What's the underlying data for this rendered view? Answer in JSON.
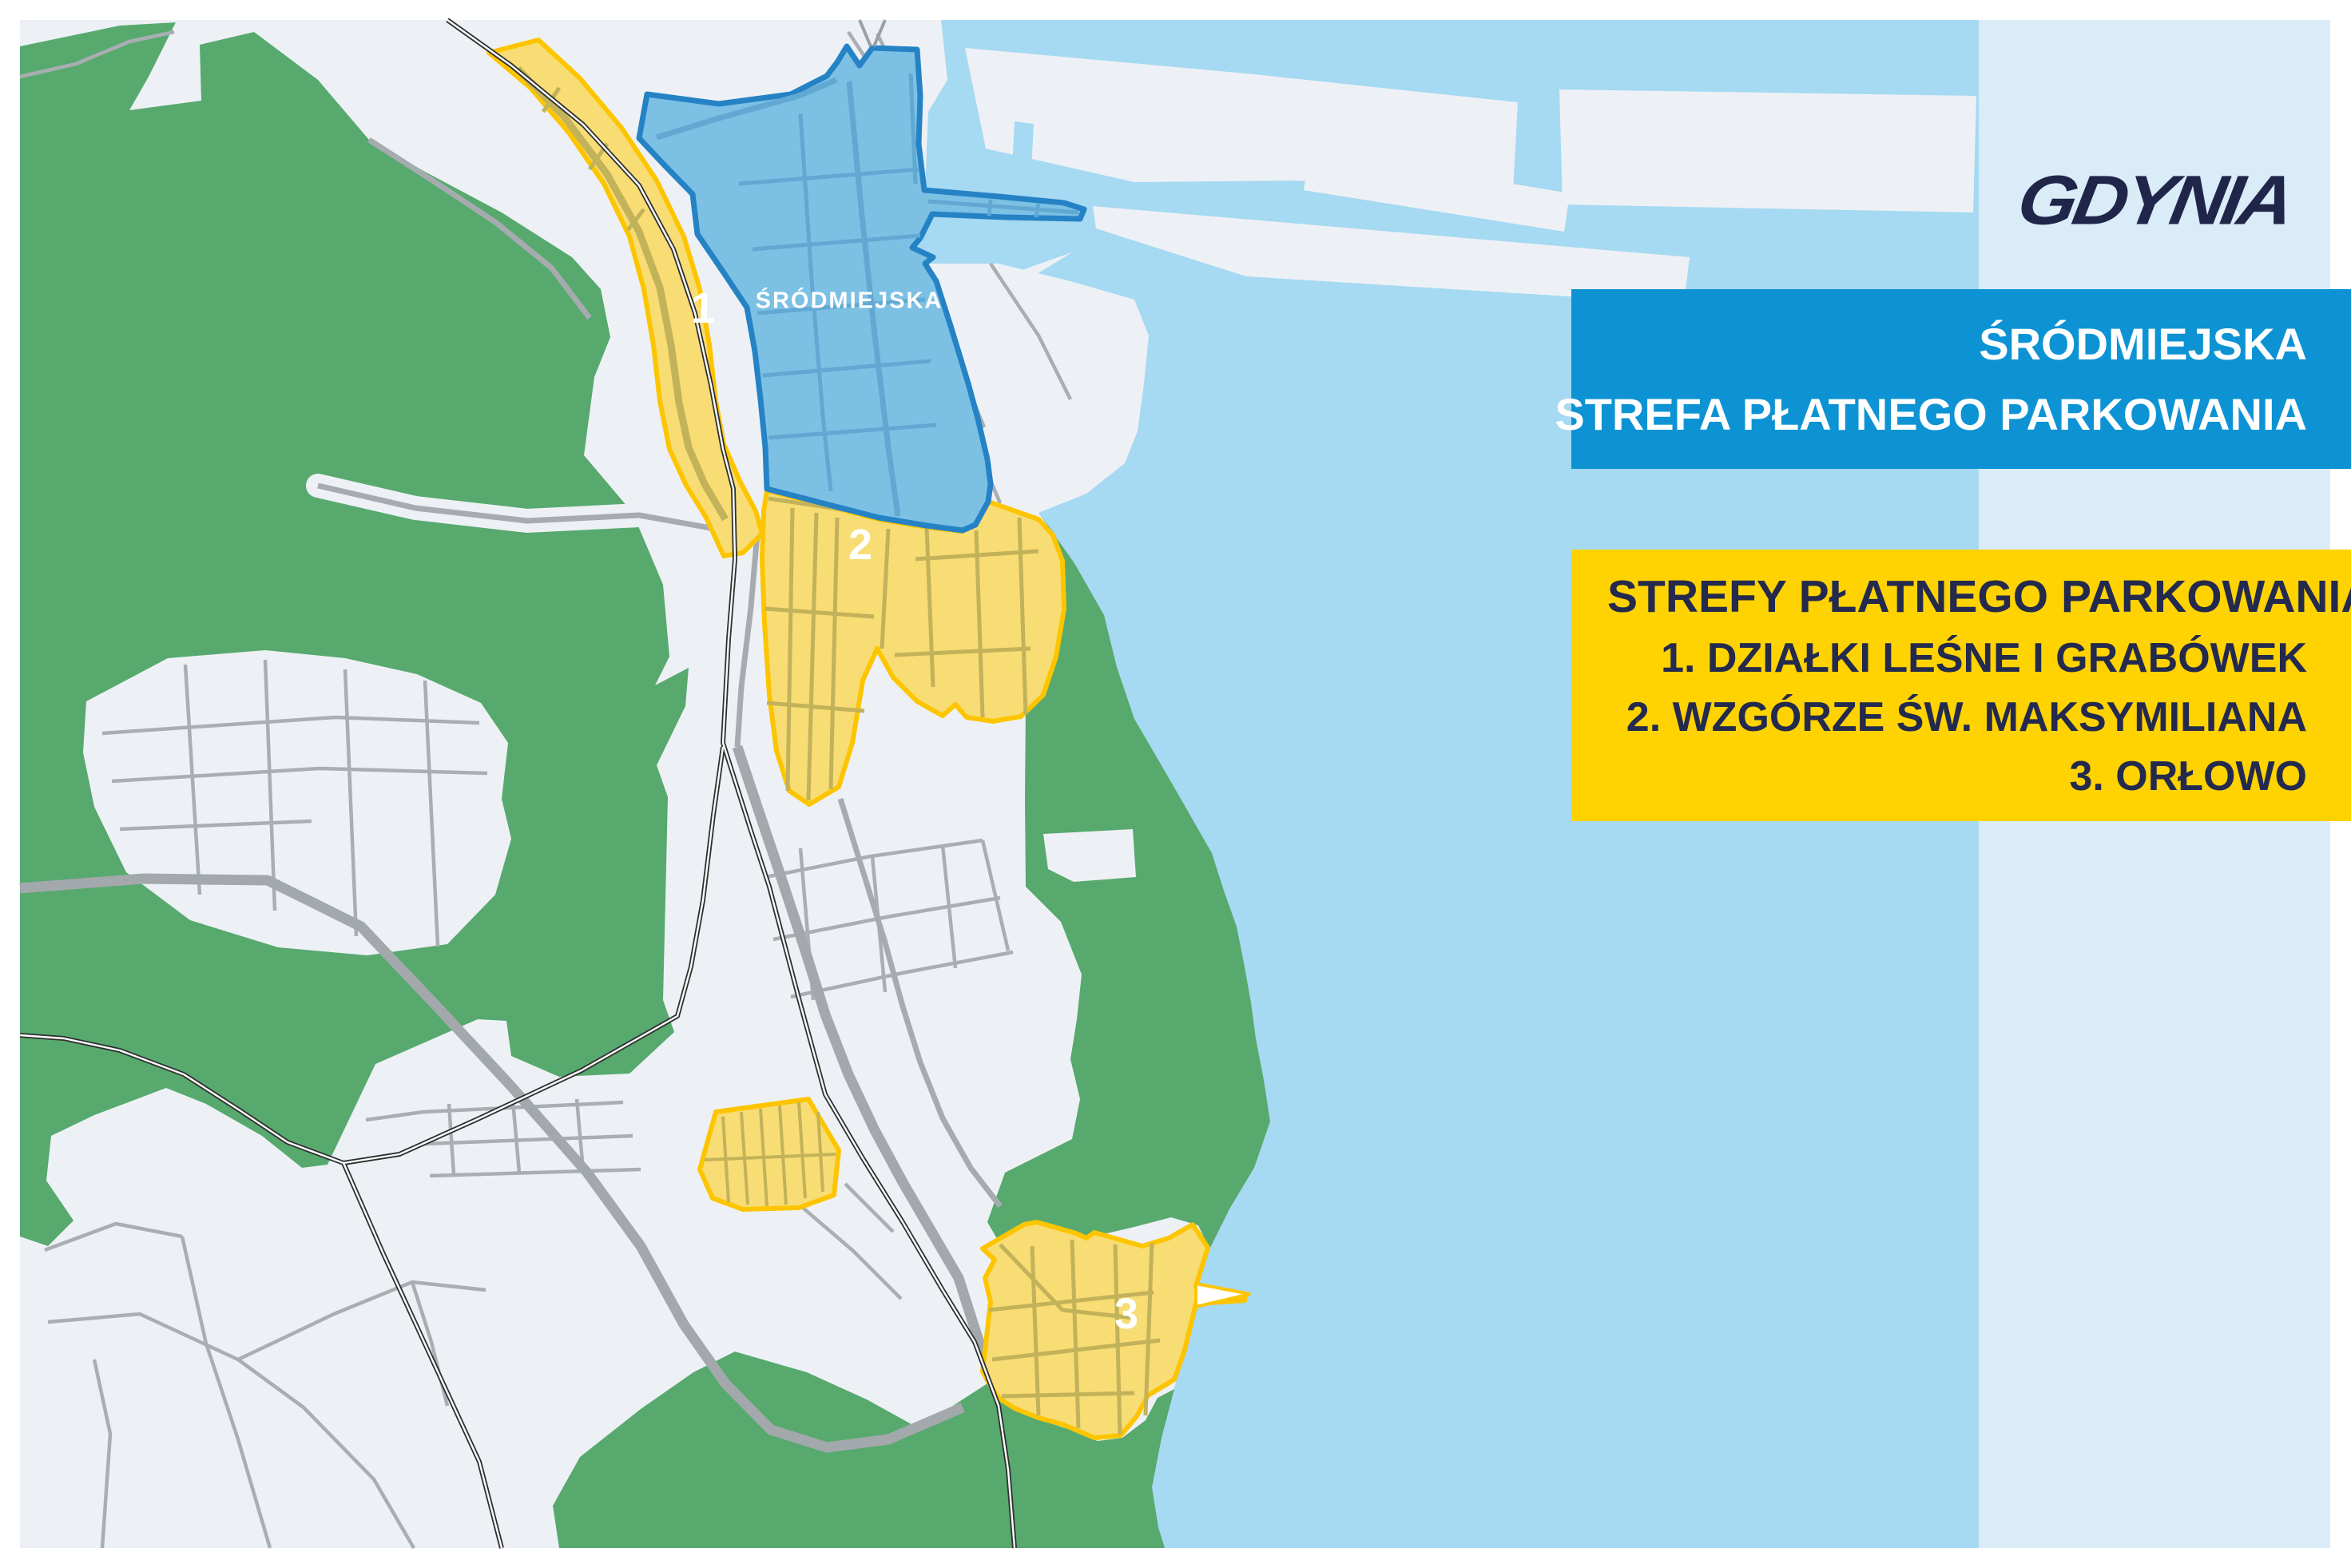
{
  "panel": {
    "logo_text": "GDYNIA",
    "logo_color": "#20264a",
    "bg": "#d9ecf8"
  },
  "banners": {
    "blue": {
      "bg": "#0d93d4",
      "text_color": "#ffffff",
      "line1": "ŚRÓDMIEJSKA",
      "line2": "STREFA PŁATNEGO PARKOWANIA"
    },
    "yellow": {
      "bg": "#ffd201",
      "text_color": "#232a4d",
      "heading": "STREFY PŁATNEGO PARKOWANIA",
      "items": [
        "1. DZIAŁKI LEŚNE I GRABÓWEK",
        "2. WZGÓRZE ŚW. MAKSYMILIANA",
        "3. ORŁOWO"
      ]
    }
  },
  "map": {
    "district_label": "ŚRÓDMIEJSKA",
    "zone_labels": [
      {
        "text": "1"
      },
      {
        "text": "2"
      },
      {
        "text": "3"
      }
    ],
    "colors": {
      "land": "#edf1f5",
      "water": "#a6d9f2",
      "forest": "#57a96e",
      "zone_yellow_fill": "#f8dc74",
      "zone_yellow_border": "#fdc500",
      "zone_street_olive": "#c2b259",
      "zone_blue_fill": "#7cc0e4",
      "zone_blue_border": "#2583c5",
      "road_gray": "#a9aeb3",
      "railway_black": "#2f2f2f"
    }
  }
}
